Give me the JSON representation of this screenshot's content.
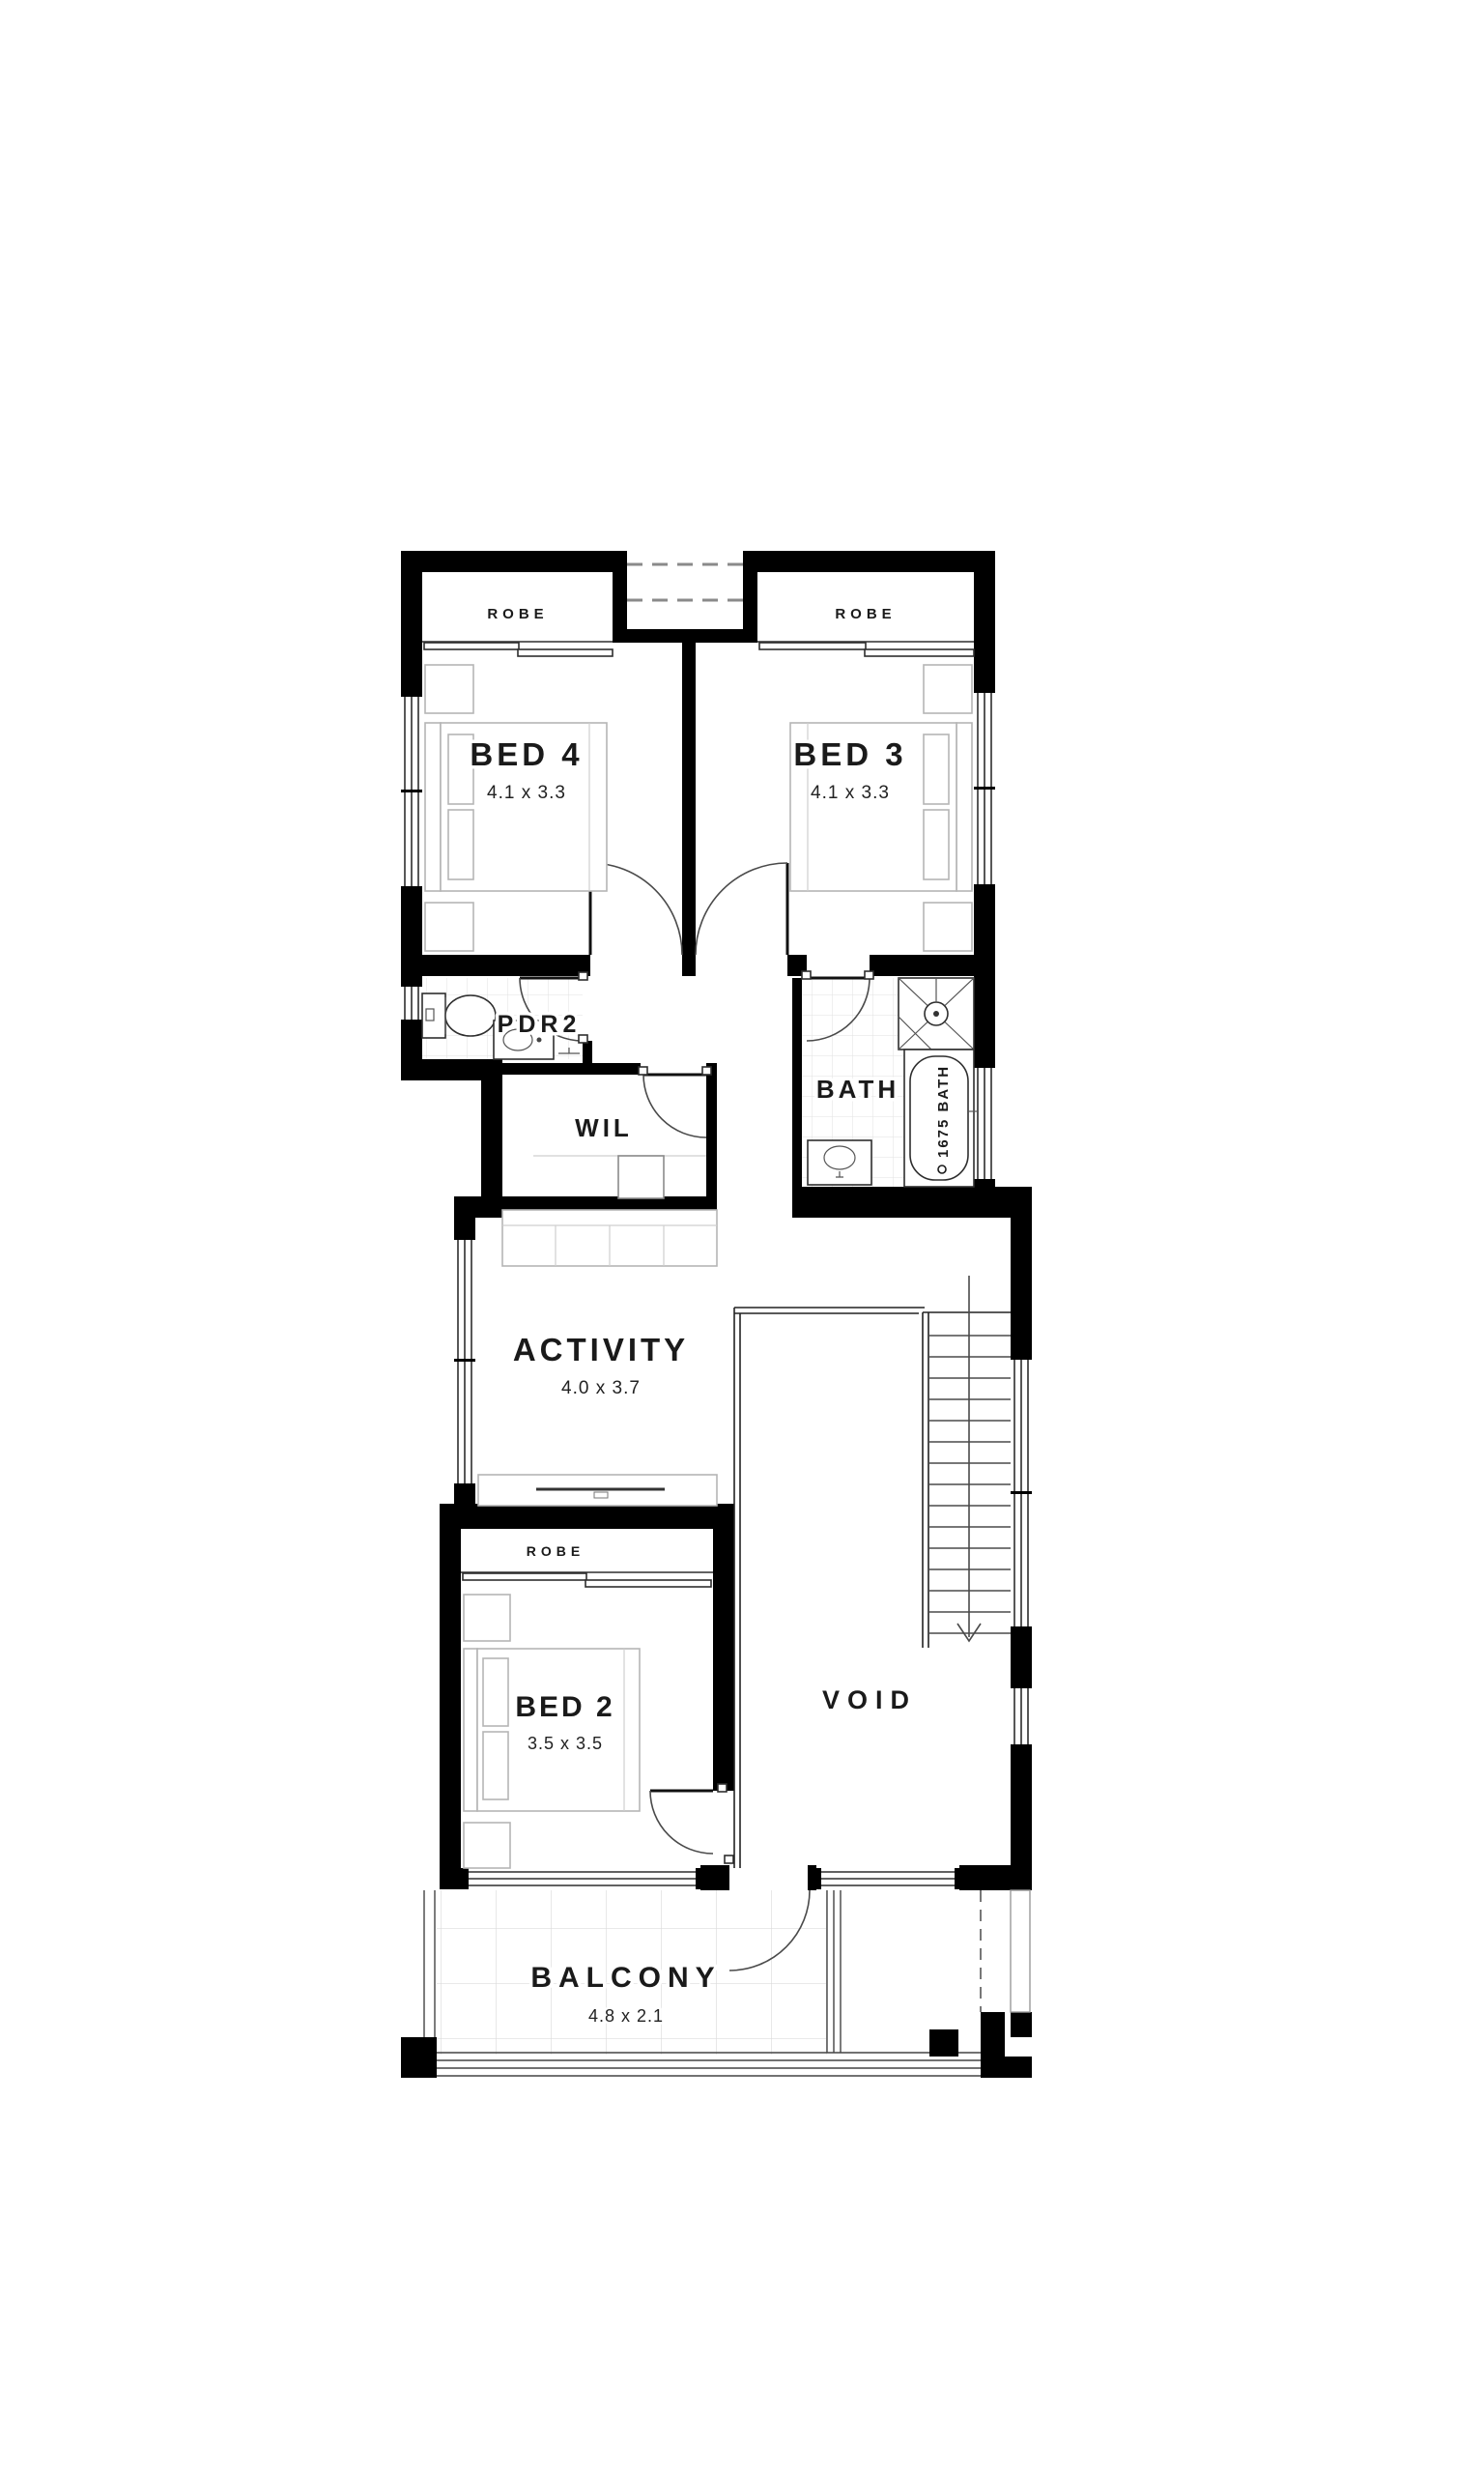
{
  "page": {
    "background": "#ffffff",
    "type": "floor-plan"
  },
  "plan": {
    "rooms": [
      {
        "key": "bed4",
        "label": "BED 4",
        "dims": "4.1 x 3.3"
      },
      {
        "key": "bed3",
        "label": "BED 3",
        "dims": "4.1 x 3.3"
      },
      {
        "key": "bed2",
        "label": "BED 2",
        "dims": "3.5 x 3.5"
      },
      {
        "key": "activity",
        "label": "ACTIVITY",
        "dims": "4.0 x 3.7"
      },
      {
        "key": "balcony",
        "label": "BALCONY",
        "dims": "4.8 x 2.1"
      },
      {
        "key": "pdr2",
        "label": "PDR2"
      },
      {
        "key": "wil",
        "label": "WIL"
      },
      {
        "key": "bath",
        "label": "BATH"
      },
      {
        "key": "void",
        "label": "VOID"
      },
      {
        "key": "robe-bed4",
        "label": "ROBE"
      },
      {
        "key": "robe-bed3",
        "label": "ROBE"
      },
      {
        "key": "robe-bed2",
        "label": "ROBE"
      }
    ],
    "fixtures": {
      "bathtub": "1675 BATH"
    },
    "colors": {
      "wall": "#000000",
      "detail_line": "#3c3c3c",
      "furniture_line": "#b5b5b5",
      "tile_line": "#e0e0e0",
      "text": "#1a1a1a",
      "background": "#ffffff"
    }
  }
}
